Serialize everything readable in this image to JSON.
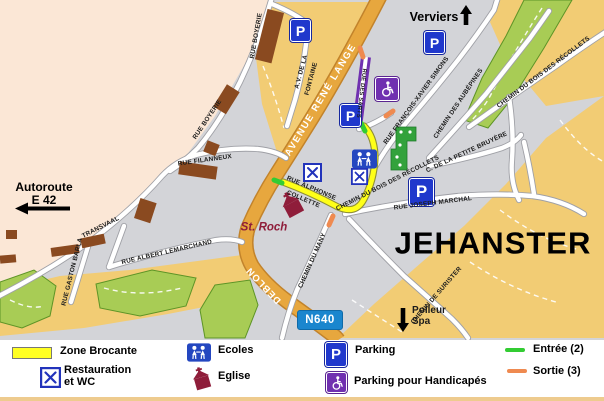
{
  "map": {
    "places": {
      "verviers": "Verviers",
      "jehanster": "JEHANSTER",
      "st_roch": "St. Roch",
      "autoroute_line1": "Autoroute",
      "autoroute_line2": "E 42",
      "polleur": "Polleur",
      "spa": "Spa",
      "n640": "N640"
    },
    "streets": {
      "rue_boyerie_upper": "RUE BOYERIE",
      "rue_boyerie_lower": "RUE BOYERIE",
      "av_de_la_line1": "A.V. DE LA",
      "av_de_la_line2": "FONTAINE",
      "rue_filanneux": "RUE FILANNEUX",
      "transvaal": "TRANSVAAL",
      "rue_gaston_barla": "RUE GASTON BARLA",
      "rue_albert_lemarchand": "RUE ALBERT LEMARCHAND",
      "avenue_rene_lange": "AVENUE RENÉ LANGE",
      "deblon": "DEBLON",
      "rue_des_sarts": "RUE DES SARTS",
      "rue_francois_xavier_simons": "RUE FRANÇOIS-XAVIER SIMONS",
      "chemin_des_aubepines": "CHEMIN DES AUBÉPINES",
      "chemin_bois_recollets_north": "CHEMIN DU BOIS DES RÉCOLLETS",
      "chemin_bois_recollets_south": "CHEMIN DU BOIS DES RÉCOLLETS",
      "rue_alphonse_line1": "RUE ALPHONSE",
      "rue_alphonse_line2": "COLLETTE",
      "petite_bruyere": "C. DE LA PETITE BRUYÈRE",
      "rue_joseph_marchal": "RUE JOSEPH MARCHAL",
      "chemin_du_many": "CHEMIN DU MANY",
      "chemin_de_surister": "CHEMIN DE SURISTER"
    },
    "badges": {
      "parking_letter": "P"
    }
  },
  "legend": {
    "zone_brocante": "Zone Brocante",
    "restauration_line1": "Restauration",
    "restauration_line2": "et WC",
    "ecoles": "Ecoles",
    "eglise": "Eglise",
    "parking": "Parking",
    "parking_handicapes": "Parking pour Handicapés",
    "entree": "Entrée (2)",
    "sortie": "Sortie (3)"
  },
  "colors": {
    "brocante_yellow": "#ffff22",
    "entree_green": "#33cc33",
    "sortie_orange": "#ef8a50",
    "parking_blue": "#2038cc",
    "handicap_purple": "#7030b0",
    "main_road_orange": "#e7a73e",
    "church_maroon": "#8f1d3a",
    "n640_blue": "#1a86ce",
    "terrain_green": "#a8cc55",
    "terrain_sand": "#f2cc74",
    "terrain_cream": "#fbe7d6",
    "terrain_gray": "#d3d4d8"
  }
}
